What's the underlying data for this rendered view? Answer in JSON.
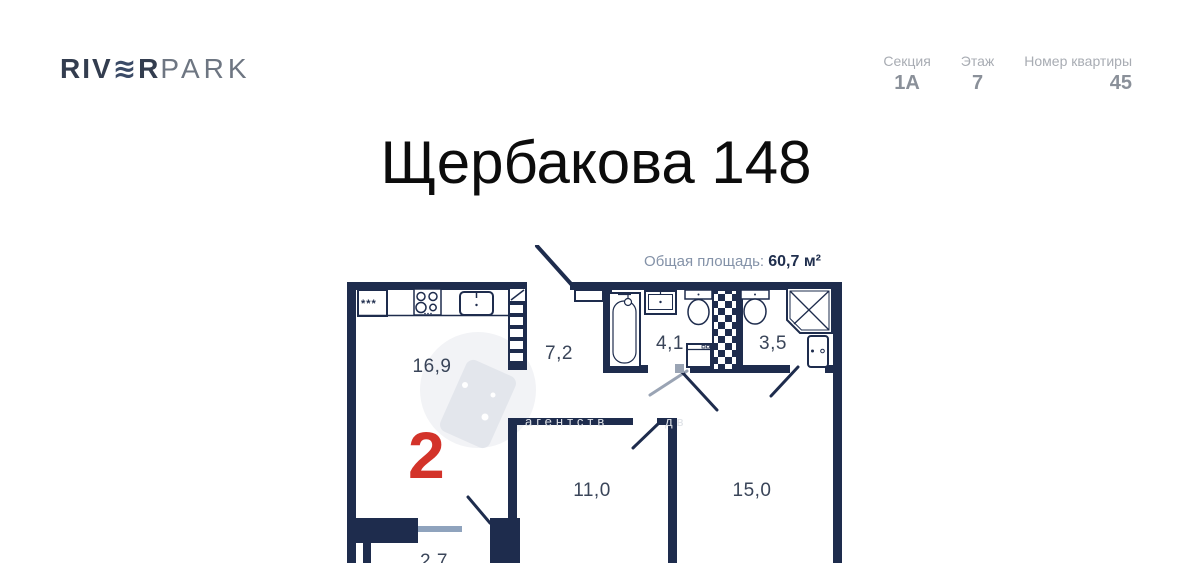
{
  "header": {
    "logo": {
      "part1": "RIV",
      "wave": "≋",
      "part2": "R",
      "part3": "PARK"
    },
    "info": [
      {
        "label": "Секция",
        "value": "1А"
      },
      {
        "label": "Этаж",
        "value": "7"
      },
      {
        "label": "Номер квартиры",
        "value": "45"
      }
    ]
  },
  "title": "Щербакова 148",
  "plan": {
    "total_area_label": "Общая площадь:",
    "total_area_value": "60,7 м²",
    "rooms_count": "2",
    "rooms": [
      {
        "name": "kitchen-living",
        "area": "16,9"
      },
      {
        "name": "hallway",
        "area": "7,2"
      },
      {
        "name": "bathroom",
        "area": "4,1"
      },
      {
        "name": "shower-room",
        "area": "3,5"
      },
      {
        "name": "bedroom-1",
        "area": "11,0"
      },
      {
        "name": "bedroom-2",
        "area": "15,0"
      },
      {
        "name": "balcony",
        "area": "2,7"
      }
    ],
    "fridge_marks": "***",
    "watermark_left": "агентств",
    "watermark_right": "дв"
  },
  "colors": {
    "wall": "#1e2c4d",
    "accent_red": "#d3332a",
    "window": "#8fa3bd"
  }
}
